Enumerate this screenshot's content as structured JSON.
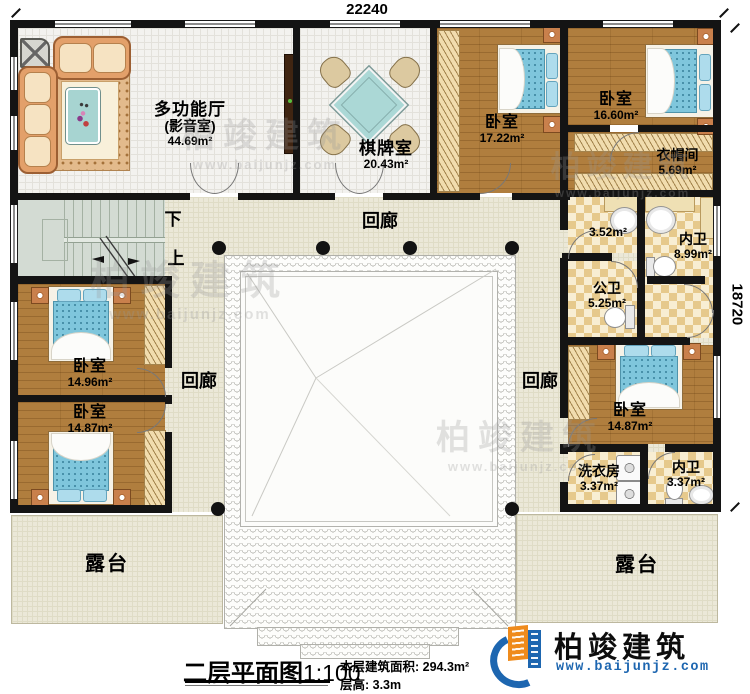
{
  "dimensions": {
    "top": "22240",
    "right": "18720"
  },
  "rooms": {
    "multi_hall": {
      "name": "多功能厅",
      "sub": "(影音室)",
      "area": "44.69m²"
    },
    "chess_room": {
      "name": "棋牌室",
      "area": "20.43m²"
    },
    "bedroom_17": {
      "name": "卧室",
      "area": "17.22m²"
    },
    "bedroom_16": {
      "name": "卧室",
      "area": "16.60m²"
    },
    "cloakroom": {
      "name": "衣帽间",
      "area": "5.69m²"
    },
    "washbasin_area": {
      "area": "3.52m²"
    },
    "inner_bath_top": {
      "name": "内卫",
      "area": "8.99m²"
    },
    "public_bath": {
      "name": "公卫",
      "area": "5.25m²"
    },
    "bedroom_left_top": {
      "name": "卧室",
      "area": "14.96m²"
    },
    "bedroom_left_bottom": {
      "name": "卧室",
      "area": "14.87m²"
    },
    "bedroom_right": {
      "name": "卧室",
      "area": "14.87m²"
    },
    "laundry": {
      "name": "洗衣房",
      "area": "3.37m²"
    },
    "inner_bath_bottom": {
      "name": "内卫",
      "area": "3.37m²"
    }
  },
  "corridors": {
    "top": "回廊",
    "left": "回廊",
    "right": "回廊"
  },
  "terraces": {
    "left": "露台",
    "right": "露台"
  },
  "stairs": {
    "down": "下",
    "up": "上"
  },
  "title": {
    "name": "二层平面图",
    "scale": "1:100"
  },
  "notes": {
    "floor_area": "本层建筑面积: 294.3m²",
    "floor_height": "层高: 3.3m"
  },
  "logo": {
    "name": "柏竣建筑",
    "url": "www.baijunjz.com"
  },
  "watermark": {
    "name": "柏竣建筑",
    "url": "www.baijunjz.com"
  },
  "colors": {
    "wall": "#141414",
    "wood_floor": "#b07e3e",
    "corridor_floor": "#ebe8d8",
    "bath_tile": "#e6c98c",
    "stairs": "#d3dbd3",
    "bed_mattress": "#7fc6dc",
    "sofa": "#e3a06a",
    "logo_blue": "#1d66b0",
    "logo_orange": "#ef8b1c"
  }
}
